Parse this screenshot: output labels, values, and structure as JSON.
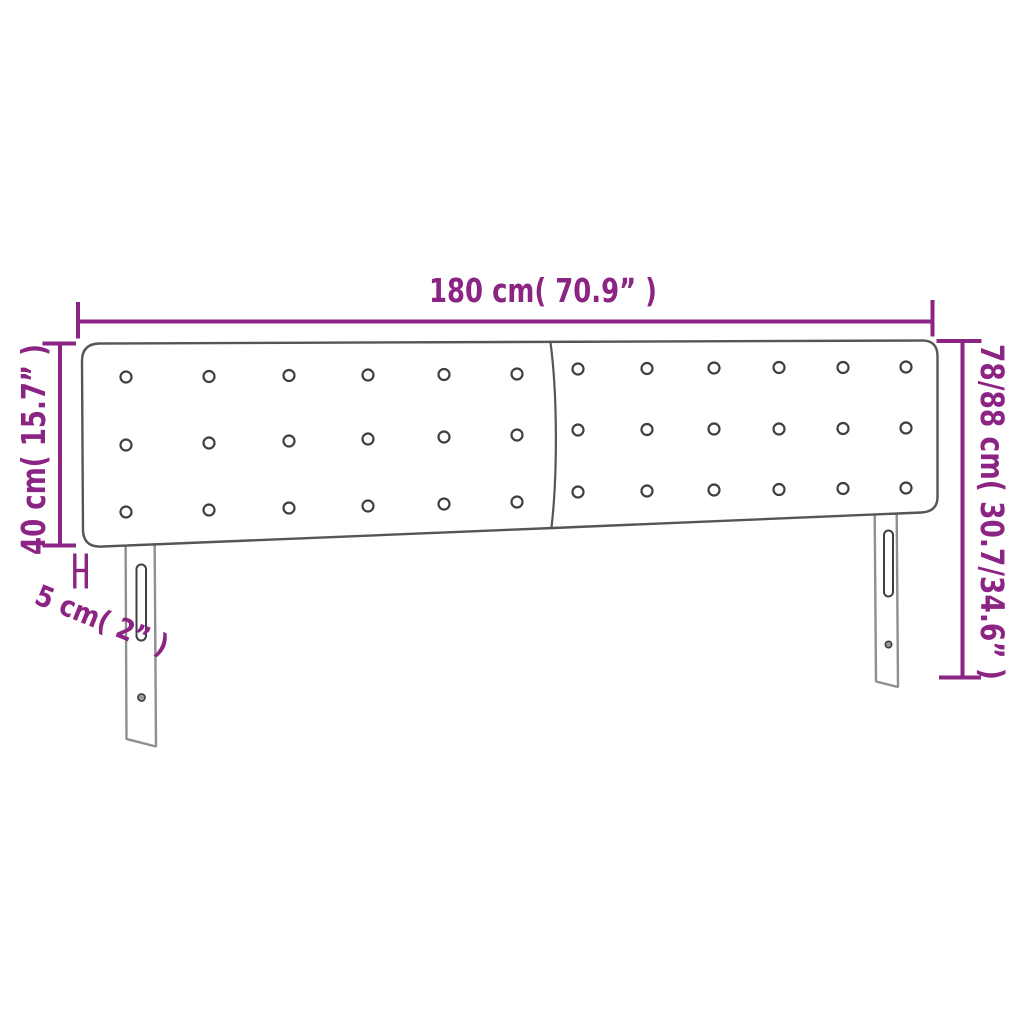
{
  "diagram": {
    "type": "product-dimension-diagram",
    "subject": "upholstered-headboard-with-buttons-two-panels-and-two-legs",
    "colors": {
      "dimension": "#8C2484",
      "outline": "#555555",
      "leg": "#8F8F8F",
      "detail": "#3F3F3F",
      "background": "#FFFFFF"
    },
    "labels": {
      "width": "180 cm( 70.9” )",
      "panel_height": "40 cm( 15.7” )",
      "total_height": "78/88 cm( 30.7/34.6” )",
      "depth": "5 cm( 2” )"
    },
    "buttons": {
      "radius": 5.5,
      "left": [
        [
          126,
          377
        ],
        [
          209,
          376.5
        ],
        [
          289,
          375.5
        ],
        [
          368,
          375
        ],
        [
          444,
          374.5
        ],
        [
          517,
          374
        ],
        [
          126,
          445
        ],
        [
          209,
          443
        ],
        [
          289,
          441
        ],
        [
          368,
          439
        ],
        [
          444,
          437
        ],
        [
          517,
          435
        ],
        [
          126,
          512
        ],
        [
          209,
          510
        ],
        [
          289,
          508
        ],
        [
          368,
          506
        ],
        [
          444,
          504
        ],
        [
          517,
          502
        ]
      ],
      "right": [
        [
          578,
          369
        ],
        [
          647,
          368.5
        ],
        [
          714,
          368
        ],
        [
          779,
          367.5
        ],
        [
          843,
          367.5
        ],
        [
          906,
          367
        ],
        [
          578,
          430
        ],
        [
          647,
          429.5
        ],
        [
          714,
          429
        ],
        [
          779,
          429
        ],
        [
          843,
          428.5
        ],
        [
          906,
          428
        ],
        [
          578,
          492
        ],
        [
          647,
          491
        ],
        [
          714,
          490
        ],
        [
          779,
          489.5
        ],
        [
          843,
          488.5
        ],
        [
          906,
          488
        ]
      ]
    }
  }
}
